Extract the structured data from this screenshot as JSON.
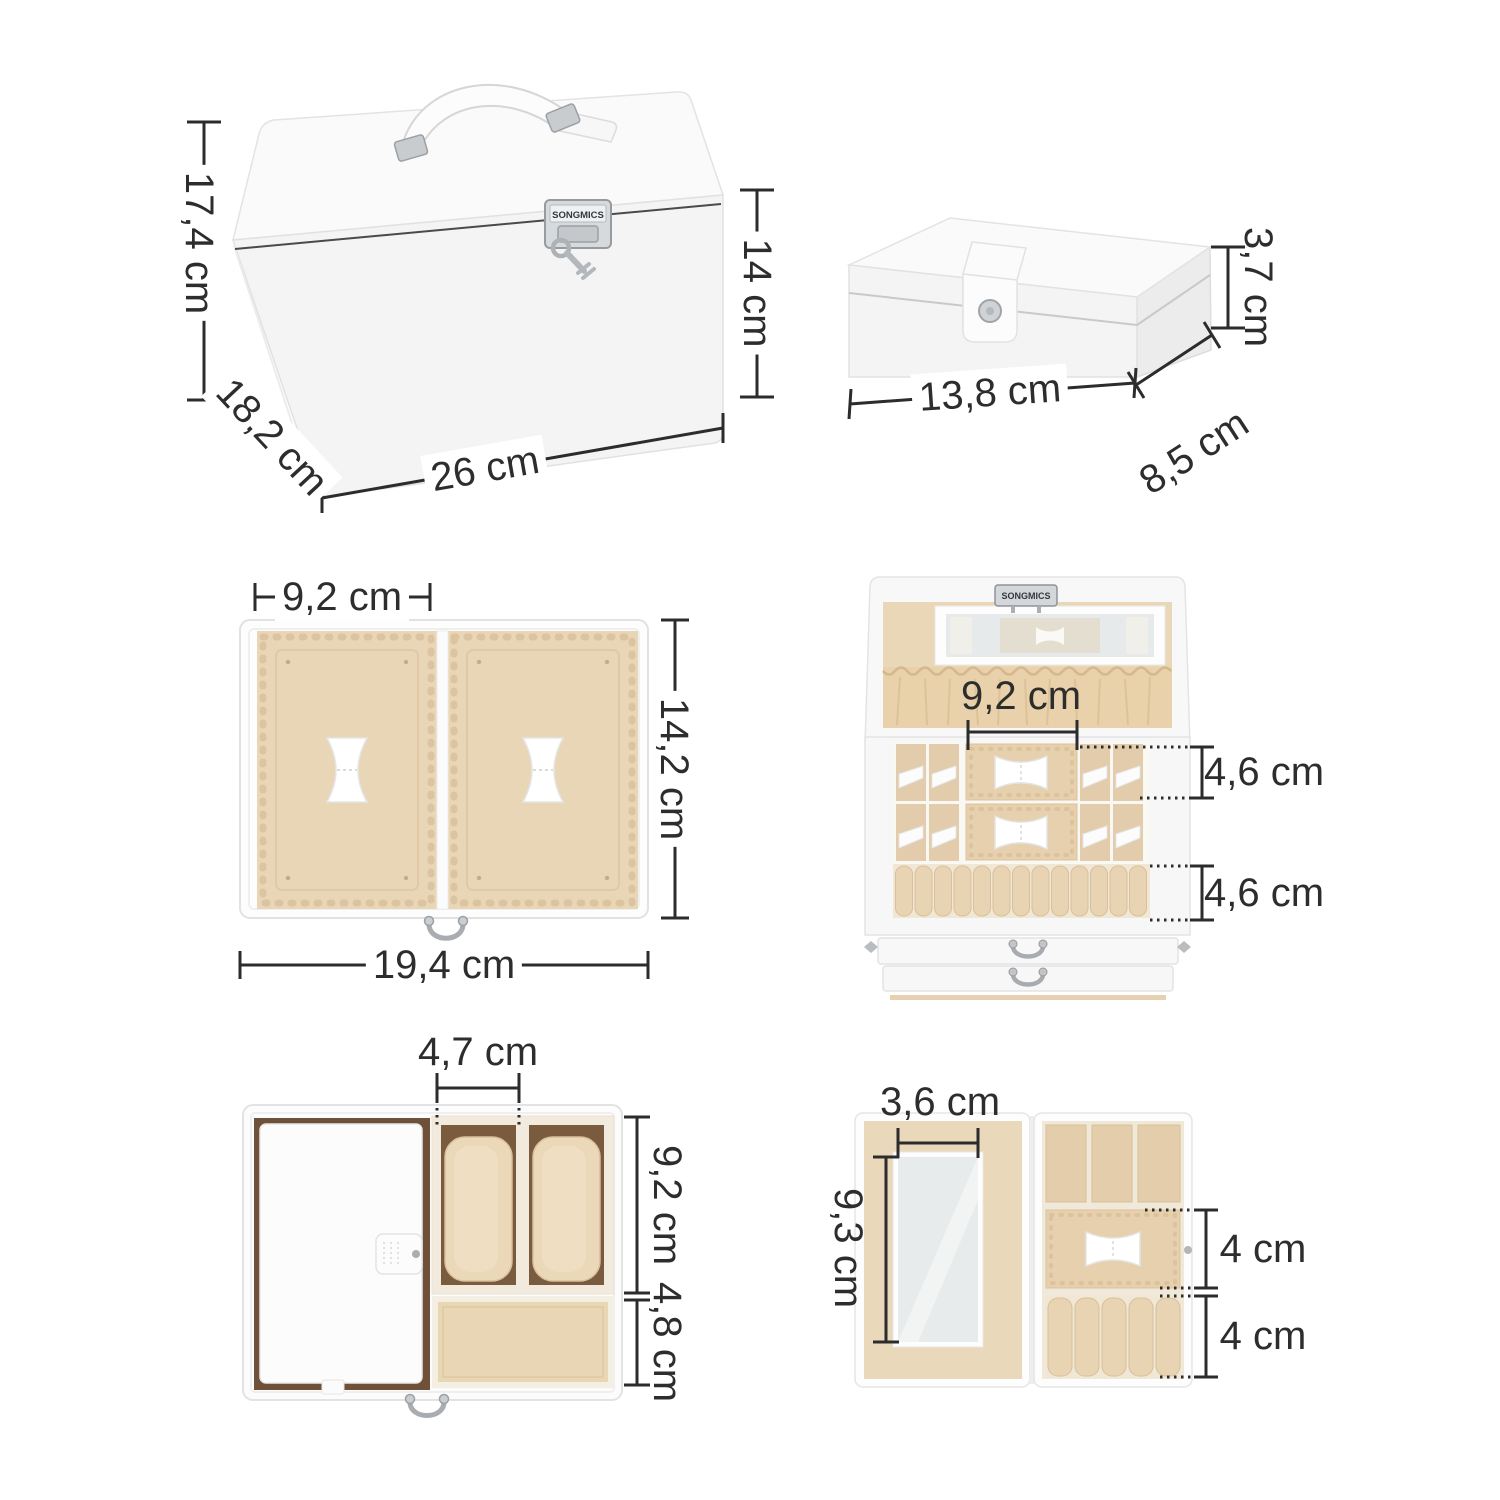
{
  "brand": "SONGMICS",
  "unit": "cm",
  "palette": {
    "line": "#2c2c2c",
    "box_white": "#f6f6f6",
    "velvet": "#e9d6b7",
    "velvet_deep": "#e2ccab",
    "ruche": "#e8d1ab",
    "wood_brown": "#6e5138",
    "metal": "#c9cccf"
  },
  "views": {
    "closed_box": {
      "title": "Closed jewellery box",
      "dimensions": {
        "total_height": "17,4 cm",
        "body_height": "14 cm",
        "width": "26 cm",
        "depth": "18,2 cm"
      }
    },
    "travel_case_closed": {
      "title": "Travel case closed",
      "dimensions": {
        "height": "3,7 cm",
        "width": "13,8 cm",
        "depth": "8,5 cm"
      }
    },
    "lid_tray": {
      "title": "Lid tray top view",
      "dimensions": {
        "compartment_width": "9,2 cm",
        "depth": "14,2 cm",
        "width": "19,4 cm"
      }
    },
    "open_box": {
      "title": "Open jewellery box",
      "dimensions": {
        "center_compartment_width": "9,2 cm",
        "top_tier_height": "4,6 cm",
        "ring_tier_height": "4,6 cm"
      }
    },
    "watch_drawer": {
      "title": "Watch drawer top view",
      "dimensions": {
        "watch_slot_width": "4,7 cm",
        "watch_section_depth": "9,2 cm",
        "front_section_depth": "4,8 cm"
      }
    },
    "travel_case_open": {
      "title": "Travel case open",
      "dimensions": {
        "mirror_width": "3,6 cm",
        "mirror_height": "9,3 cm",
        "middle_section_height": "4 cm",
        "ring_section_height": "4 cm"
      }
    }
  }
}
